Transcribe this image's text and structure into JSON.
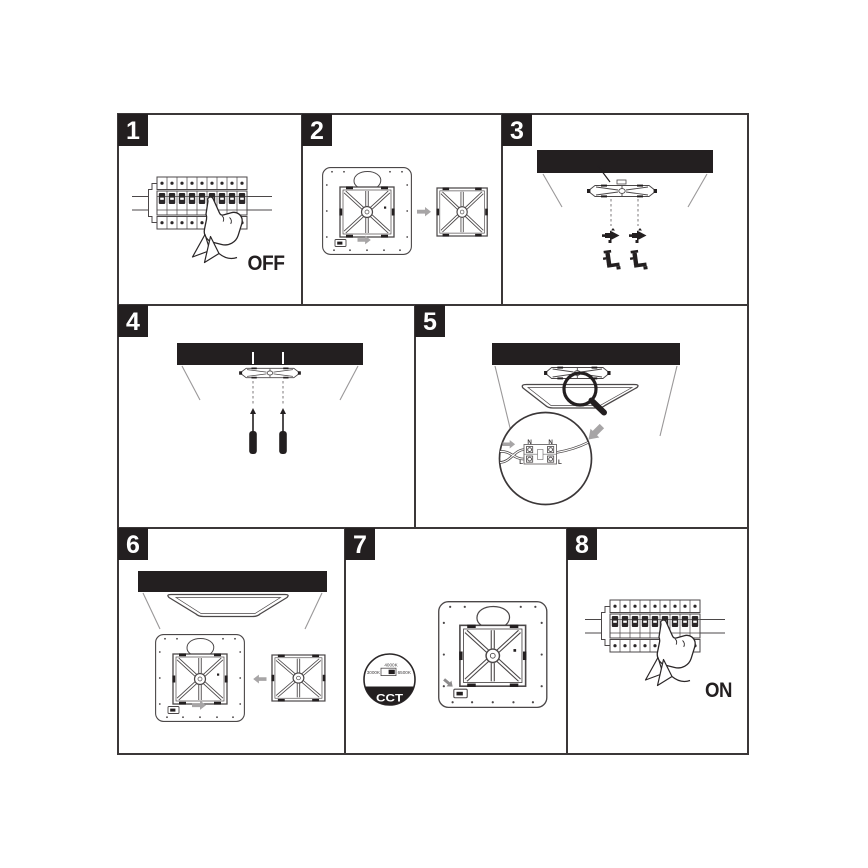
{
  "document": {
    "kind": "led-panel-installation-instructions",
    "step_count": "8"
  },
  "colors": {
    "ink": "#231f20",
    "line": "#4b4748",
    "cell_border": "#3b3738",
    "gray_arrow": "#a7a5a6",
    "background": "#ffffff"
  },
  "steps": {
    "s1": {
      "number": "1",
      "caption": "OFF"
    },
    "s2": {
      "number": "2"
    },
    "s3": {
      "number": "3"
    },
    "s4": {
      "number": "4"
    },
    "s5": {
      "number": "5",
      "terminal": {
        "n_left": "N",
        "n_right": "N",
        "l_left": "L",
        "l_right": "L"
      }
    },
    "s6": {
      "number": "6"
    },
    "s7": {
      "number": "7",
      "cct": {
        "label": "CCT",
        "top": "4000K",
        "left": "3000K",
        "right": "6500K"
      }
    },
    "s8": {
      "number": "8",
      "caption": "ON"
    }
  }
}
